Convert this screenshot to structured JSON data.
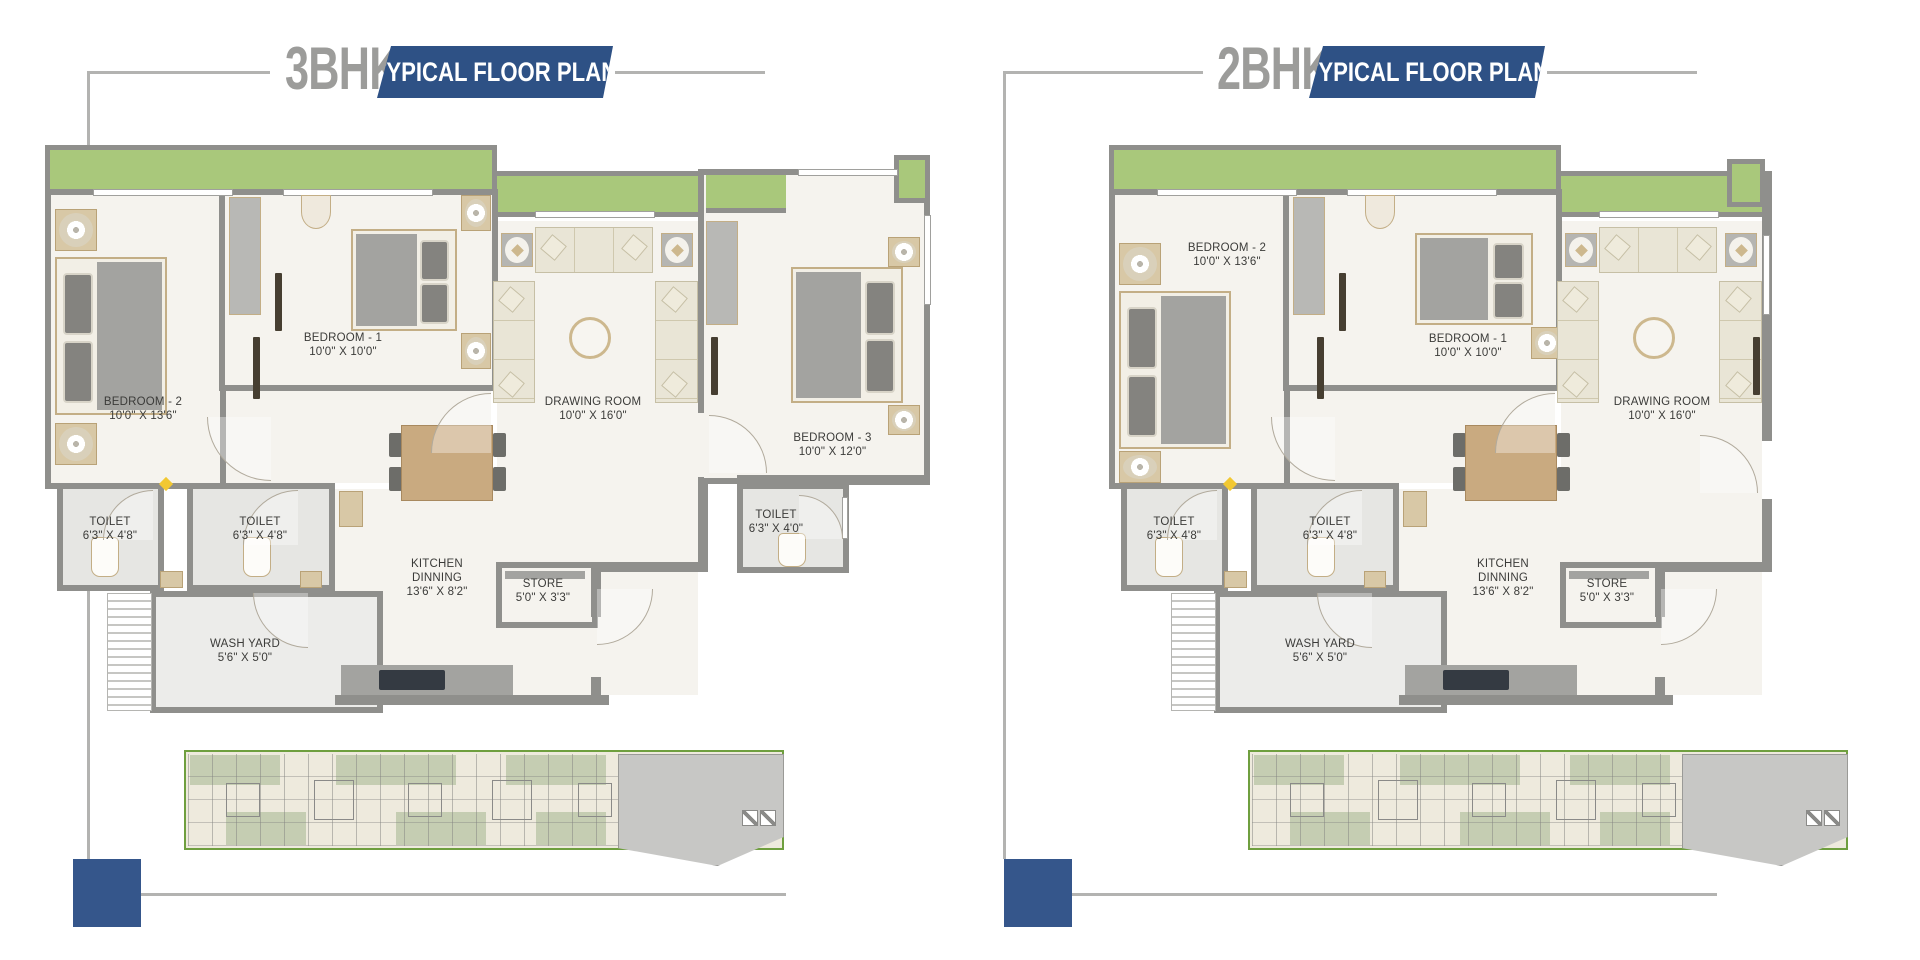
{
  "plans": [
    {
      "unit": "3BHK",
      "banner": "TYPICAL FLOOR PLAN",
      "labels": {
        "bedroom2": {
          "name": "BEDROOM - 2",
          "dims": "10'0\" X 13'6\""
        },
        "bedroom1": {
          "name": "BEDROOM - 1",
          "dims": "10'0\" X 10'0\""
        },
        "bedroom3": {
          "name": "BEDROOM - 3",
          "dims": "10'0\" X 12'0\""
        },
        "drawing_room": {
          "name": "DRAWING ROOM",
          "dims": "10'0\" X 16'0\""
        },
        "toilet_left": {
          "name": "TOILET",
          "dims": "6'3\" X 4'8\""
        },
        "toilet_mid": {
          "name": "TOILET",
          "dims": "6'3\" X 4'8\""
        },
        "toilet_right": {
          "name": "TOILET",
          "dims": "6'3\" X 4'0\""
        },
        "kitchen": {
          "name_line1": "KITCHEN",
          "name_line2": "DINNING",
          "dims": "13'6\" X 8'2\""
        },
        "store": {
          "name": "STORE",
          "dims": "5'0\" X 3'3\""
        },
        "wash_yard": {
          "name": "WASH YARD",
          "dims": "5'6\" X 5'0\""
        }
      }
    },
    {
      "unit": "2BHK",
      "banner": "TYPICAL FLOOR PLAN",
      "labels": {
        "bedroom2": {
          "name": "BEDROOM - 2",
          "dims": "10'0\" X 13'6\""
        },
        "bedroom1": {
          "name": "BEDROOM - 1",
          "dims": "10'0\" X 10'0\""
        },
        "drawing_room": {
          "name": "DRAWING ROOM",
          "dims": "10'0\" X 16'0\""
        },
        "toilet_left": {
          "name": "TOILET",
          "dims": "6'3\" X 4'8\""
        },
        "toilet_mid": {
          "name": "TOILET",
          "dims": "6'3\" X 4'8\""
        },
        "kitchen": {
          "name_line1": "KITCHEN",
          "name_line2": "DINNING",
          "dims": "13'6\" X 8'2\""
        },
        "store": {
          "name": "STORE",
          "dims": "5'0\" X 3'3\""
        },
        "wash_yard": {
          "name": "WASH YARD",
          "dims": "5'6\" X 5'0\""
        }
      }
    }
  ],
  "colors": {
    "banner_blue": "#2e5185",
    "title_gray": "#9c9c9a",
    "wall": "#8f8f8c",
    "floor": "#f5f3ee",
    "wet_floor": "#e6e6e3",
    "balcony_green": "#a9c87b",
    "furniture_tan": "#d8c8a6",
    "mattress_gray": "#a3a3a0",
    "sofa_cream": "#e9e5d6",
    "keyplan_green": "#6f9f3f",
    "navy_square": "#35568b",
    "line_gray": "#b3b3b1"
  }
}
